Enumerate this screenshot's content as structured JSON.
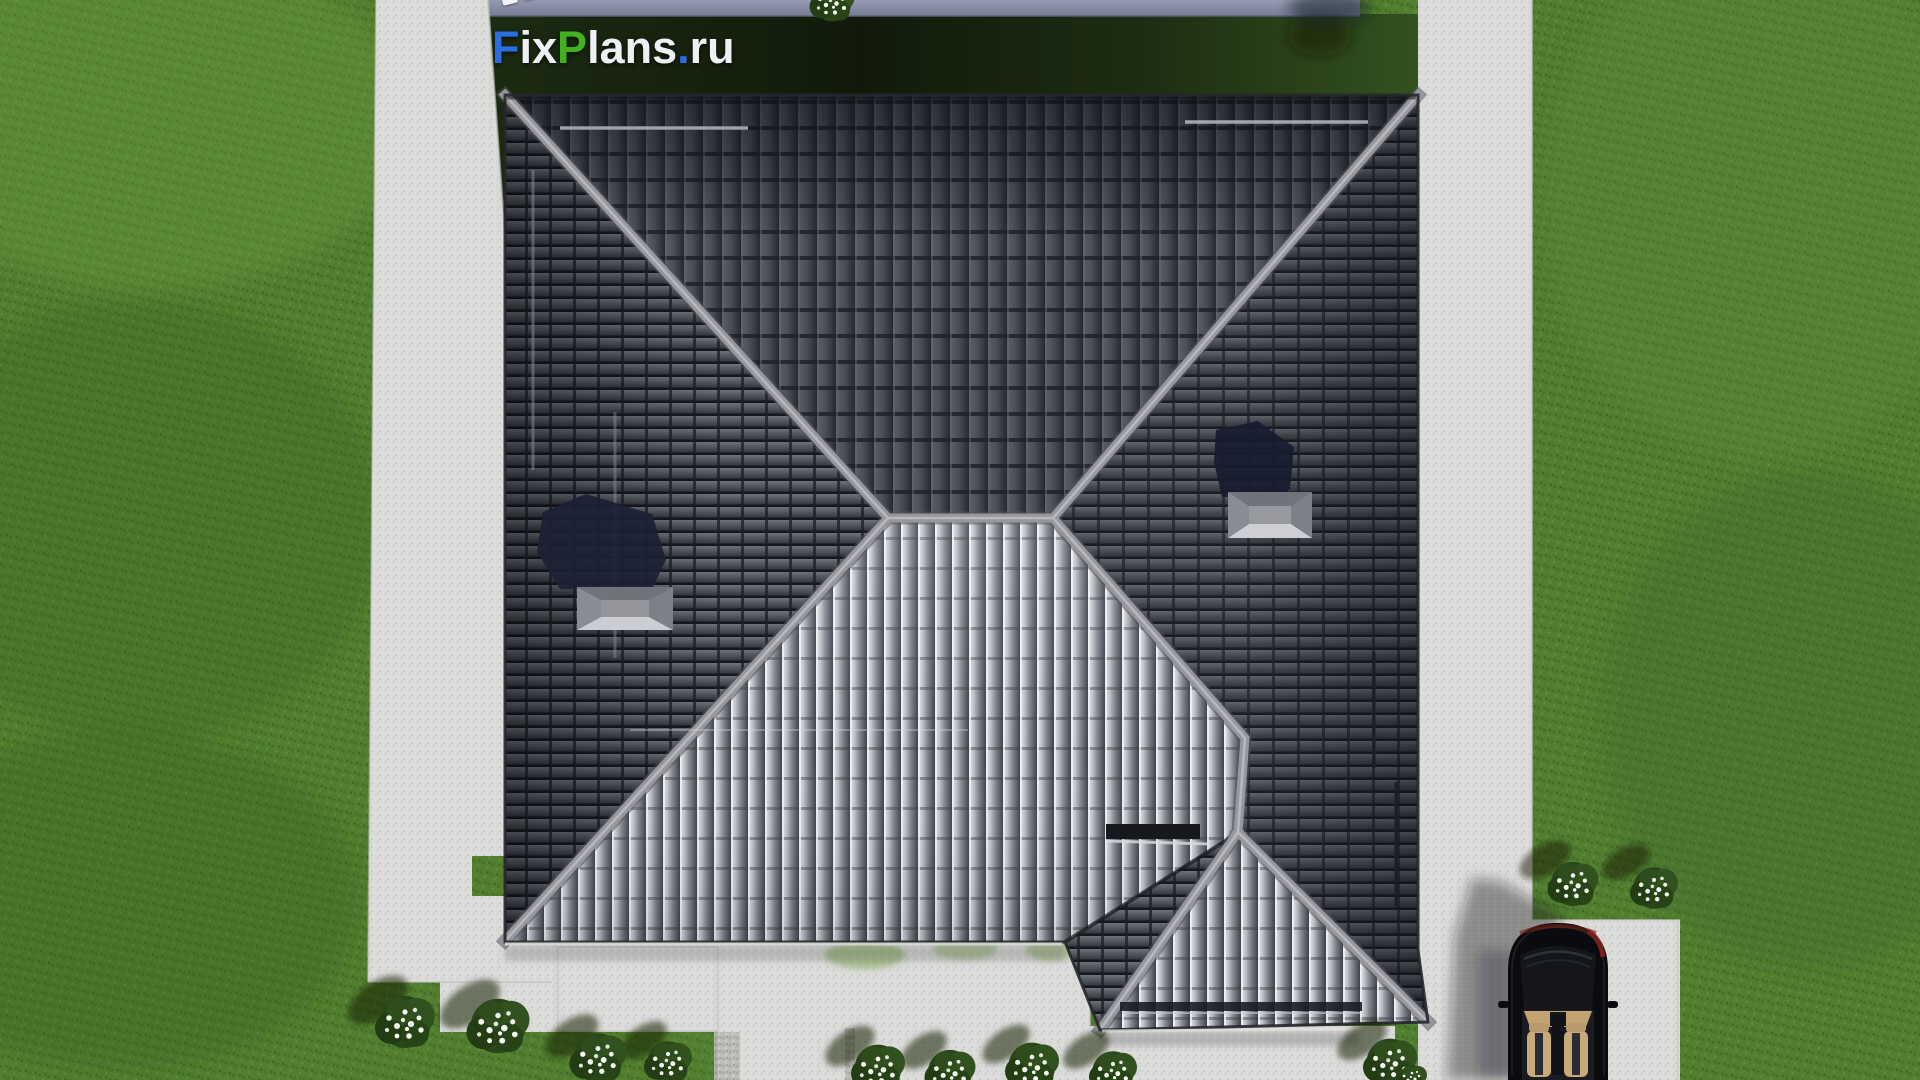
{
  "watermark": {
    "text": "FixPlans.ru",
    "letters": [
      {
        "ch": "F",
        "color": "#2b6de2"
      },
      {
        "ch": "i",
        "color": "#eef0f4"
      },
      {
        "ch": "x",
        "color": "#eef0f4"
      },
      {
        "ch": "P",
        "color": "#43b01f"
      },
      {
        "ch": "l",
        "color": "#eef0f4"
      },
      {
        "ch": "a",
        "color": "#eef0f4"
      },
      {
        "ch": "n",
        "color": "#eef0f4"
      },
      {
        "ch": "s",
        "color": "#eef0f4"
      },
      {
        "ch": ".",
        "color": "#2b6de2"
      },
      {
        "ch": "r",
        "color": "#eef0f4"
      },
      {
        "ch": "u",
        "color": "#eef0f4"
      }
    ]
  },
  "mini_watermark": {
    "description": "partially visible watermark letter tiles cut off at top edge",
    "tile_colors": [
      "#f2f3f5",
      "#f2f3f5",
      "#f2f3f5",
      "#f2f3f5",
      "#2b6de2",
      "#f2f3f5",
      "#2b6de2"
    ]
  },
  "scene": {
    "type": "top-down aerial 3D architectural render of a house roof plan",
    "objects": [
      "green lawn",
      "left concrete walkway",
      "top boundary wall strip",
      "dark shaded house plot",
      "main gray-tile hip roof",
      "central ridge and hip ridges",
      "garage hip roof wing",
      "left roof skylight with cast shadow",
      "right roof skylight with cast shadow",
      "snow guard rails",
      "roof vent bar",
      "rear patio",
      "garden walkway",
      "right concrete walkway",
      "driveway",
      "black convertible car with tan interior",
      "white flower bushes"
    ]
  },
  "palette": {
    "lawn": "#527e30",
    "lawn_light": "#6b9a40",
    "lawn_dark": "#3c6123",
    "concrete": "#dadad8",
    "paver": "#b9b9b5",
    "plot_dark": "#121d0b",
    "plot_green": "#33511f",
    "wall_strip": "#8a90a8",
    "roof_dark": "#34373e",
    "roof_mid": "#4a4e56",
    "roof_bright": "#c9cbd1",
    "ridge": "#97989e",
    "skylight_shadow": "#1b2134",
    "car_body": "#0a0b0e",
    "car_interior": "#c9aa7a",
    "car_tail": "#7c2018",
    "flower": "#f4f6f2",
    "bush": "#2a451a"
  }
}
